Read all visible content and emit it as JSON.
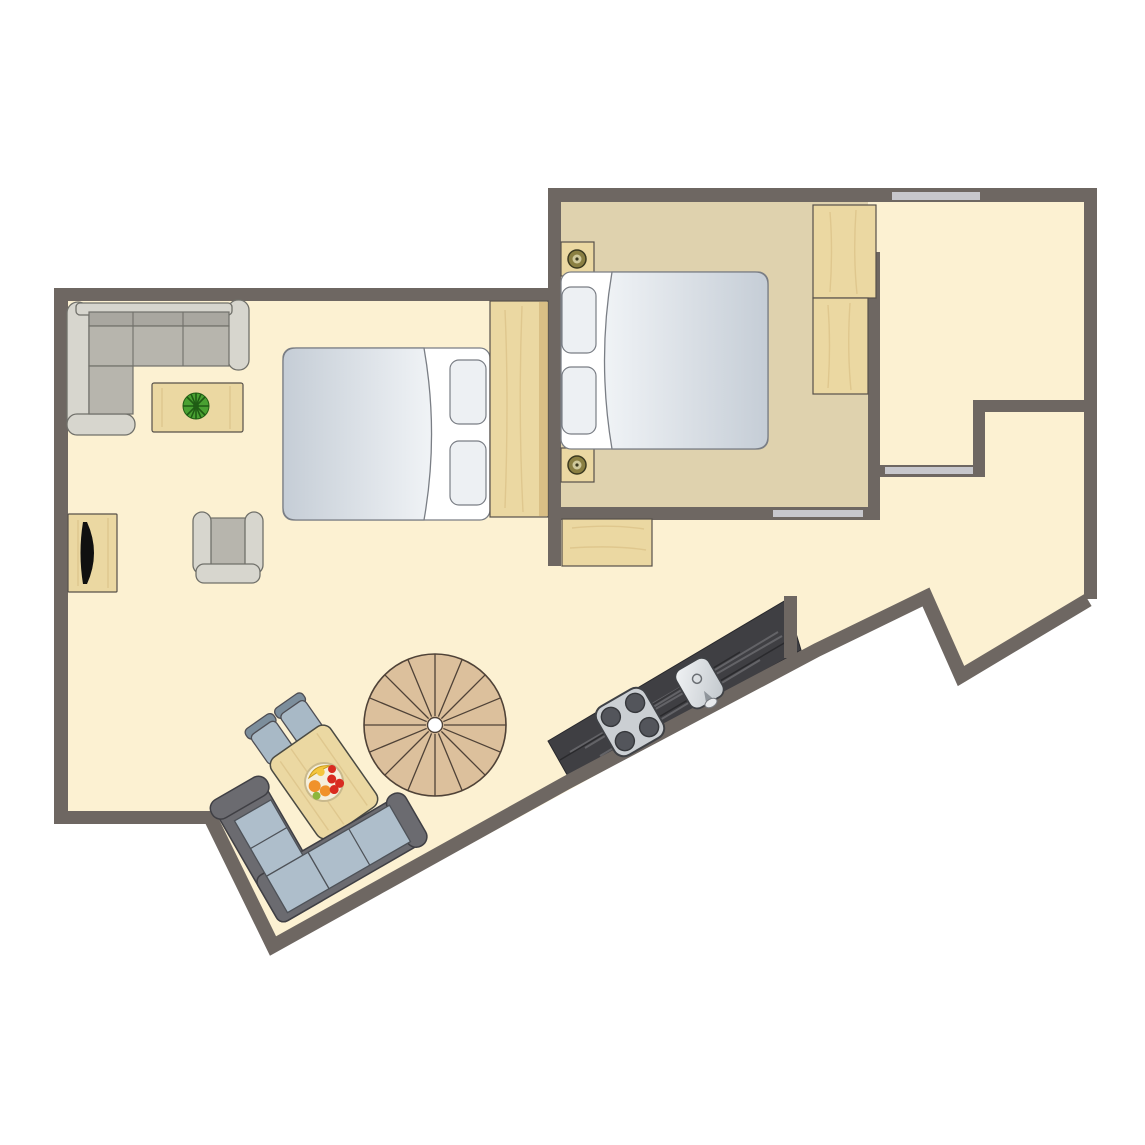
{
  "title": "apartment-floor-plan",
  "colors": {
    "page_bg": "#FFFFFF",
    "wall": "#6E6762",
    "opening": "#C7C7CC",
    "floor_main": "#FCF1D2",
    "floor_bedroom": "#DFD2AE",
    "wood": "#EBD8A2",
    "wood_dark": "#D5B97E",
    "wood_stroke": "#57514A",
    "stairs_wood": "#DCC09C",
    "stairs_line": "#4F4237",
    "counter": "#3F3F43",
    "counter_streak": "#909094",
    "steel": "#CBCFD3",
    "burner": "#53555B",
    "bed_duvet_dark": "#C5CDD6",
    "bed_duvet_light": "#F0F3F6",
    "bed_outline": "#7A7E85",
    "pillow": "#EDF0F3",
    "sofa1_frame": "#D7D6CE",
    "sofa1_back": "#A9A7A0",
    "sofa1_seat": "#B7B5AD",
    "sofa1_stroke": "#70706A",
    "sofa2_frame": "#6B6B70",
    "sofa2_cushion": "#AEBECB",
    "sofa2_stroke": "#3F3F44",
    "chair_seat": "#A8B9C6",
    "chair_back": "#7C8E9C",
    "plant_green": "#49A132",
    "plant_dark": "#1F5C14",
    "bowl": "#F5EFDC",
    "bowl_rim": "#C9B98C",
    "fruit_orange": "#F0922B",
    "fruit_red": "#D92B20",
    "fruit_yellow": "#F5C63F",
    "fruit_green": "#8CB63C",
    "tv": "#101010",
    "lamp_ring": "#8A7F42",
    "lamp_center": "#CFC89B",
    "lamp_stroke": "#3C3A20"
  },
  "rooms": [
    {
      "name": "living-area",
      "floor": "floor_main"
    },
    {
      "name": "bedroom",
      "floor": "floor_bedroom"
    },
    {
      "name": "upper-right-room",
      "floor": "floor_main"
    }
  ],
  "openings": [
    {
      "name": "window-top-wall"
    },
    {
      "name": "door-bedroom-south"
    },
    {
      "name": "door-right-room"
    }
  ],
  "furniture": [
    "corner-sofa-living",
    "coffee-table",
    "potted-plant",
    "tv-sideboard",
    "armchair",
    "double-bed-living",
    "wardrobe-living",
    "double-bed-bedroom",
    "nightstand-top",
    "nightstand-bottom",
    "wardrobe-bedroom-upper",
    "wardrobe-bedroom-lower",
    "hall-cabinet",
    "spiral-staircase",
    "kitchen-counter",
    "cooktop",
    "sink",
    "dining-table",
    "dining-chair-1",
    "dining-chair-2",
    "fruit-bowl",
    "corner-sofa-dining"
  ]
}
